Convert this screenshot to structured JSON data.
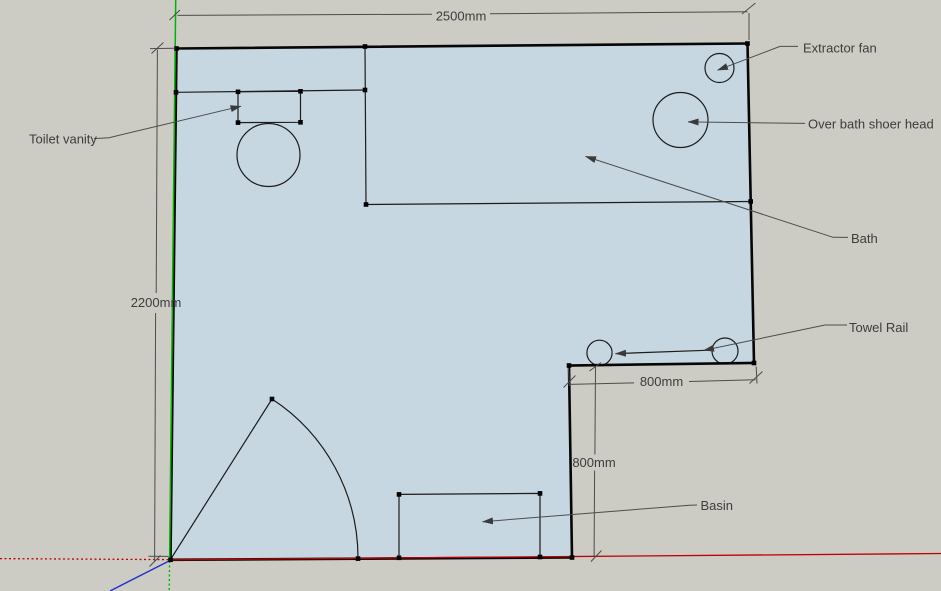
{
  "scene": {
    "background_color": "#cccbc4",
    "room_fill_color": "#c7d7e1",
    "edge_color": "#1c1c1c",
    "annotation_color": "#3d3d3d",
    "axis_colors": {
      "red": "#be0000",
      "green": "#00b400",
      "blue": "#2233cc"
    }
  },
  "dimensions": {
    "room_width": "2500mm",
    "room_height": "2200mm",
    "notch_width": "800mm",
    "notch_depth": "800mm"
  },
  "labels": {
    "toilet_vanity": "Toilet vanity",
    "extractor_fan": "Extractor fan",
    "shower_head": "Over bath shoer head",
    "bath": "Bath",
    "towel_rail": "Towel Rail",
    "basin": "Basin"
  },
  "fixtures": [
    "toilet-bowl-circle",
    "toilet-vanity-rectangle",
    "bath-area",
    "shower-head-circle",
    "extractor-fan-circle",
    "towel-rail-posts",
    "basin-rectangle",
    "door-swing"
  ]
}
